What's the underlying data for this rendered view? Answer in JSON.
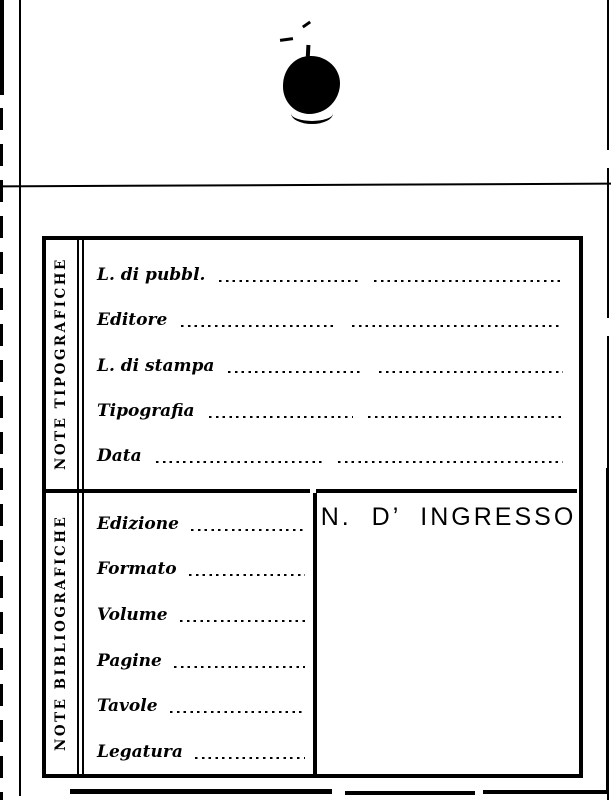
{
  "page": {
    "background": "#ffffff",
    "ink": "#000000",
    "artifact_names": [
      "ink-blot-stain",
      "scan-edge-marks"
    ]
  },
  "card": {
    "sections": {
      "tipografiche": {
        "sidebar_label": "NOTE TIPOGRAFICHE",
        "fields": [
          {
            "label": "L. di pubbl.",
            "value": ""
          },
          {
            "label": "Editore",
            "value": ""
          },
          {
            "label": "L. di stampa",
            "value": ""
          },
          {
            "label": "Tipografia",
            "value": ""
          },
          {
            "label": "Data",
            "value": ""
          }
        ]
      },
      "bibliografiche": {
        "sidebar_label": "NOTE BIBLIOGRAFICHE",
        "fields": [
          {
            "label": "Edizione",
            "value": ""
          },
          {
            "label": "Formato",
            "value": ""
          },
          {
            "label": "Volume",
            "value": ""
          },
          {
            "label": "Pagine",
            "value": ""
          },
          {
            "label": "Tavole",
            "value": ""
          },
          {
            "label": "Legatura",
            "value": ""
          }
        ]
      },
      "ingresso": {
        "header": "N. D’ INGRESSO"
      }
    }
  }
}
